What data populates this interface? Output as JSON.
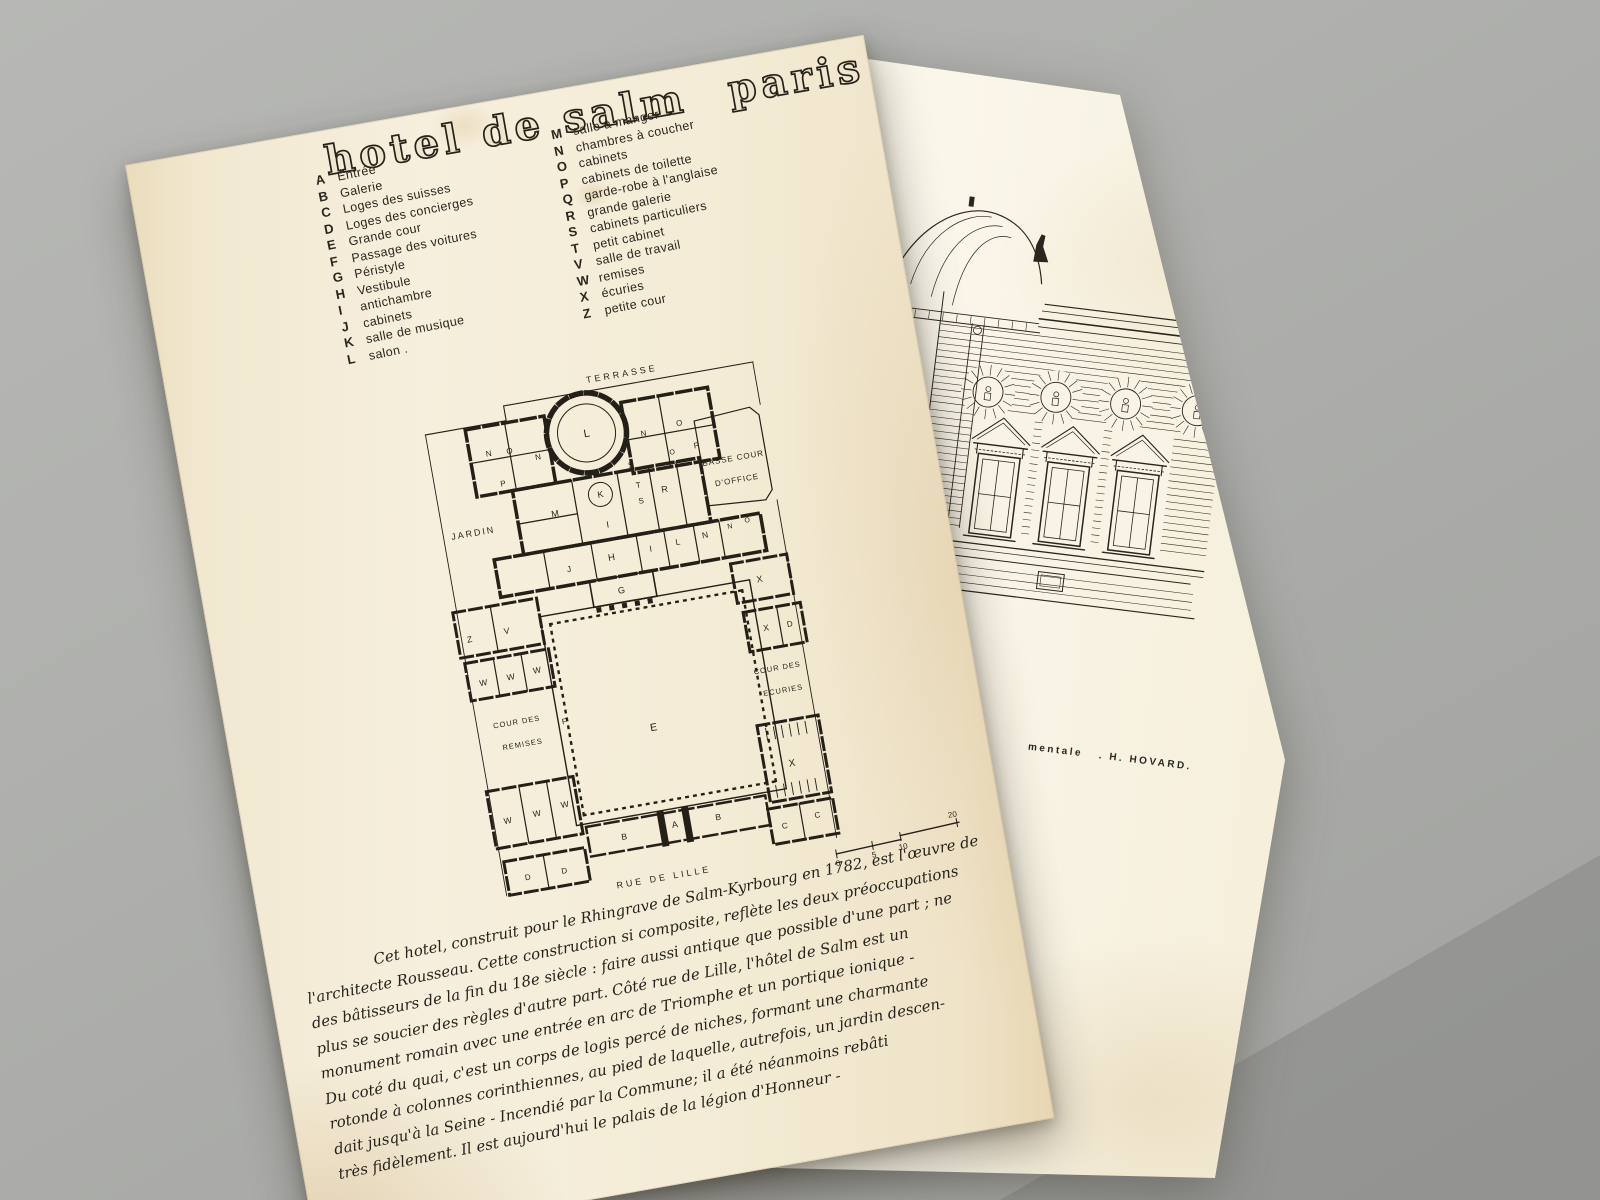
{
  "colors": {
    "background": "#aeafac",
    "paper_front": "#f4ecd7",
    "paper_back": "#f9f4e5",
    "ink": "#241f17"
  },
  "front_sheet": {
    "title_part1": "hotel de salm",
    "title_part2": "paris",
    "legend_left": [
      {
        "key": "A",
        "label": "Entrée"
      },
      {
        "key": "B",
        "label": "Galerie"
      },
      {
        "key": "C",
        "label": "Loges des suisses"
      },
      {
        "key": "D",
        "label": "Loges des concierges"
      },
      {
        "key": "E",
        "label": "Grande cour"
      },
      {
        "key": "F",
        "label": "Passage des voitures"
      },
      {
        "key": "G",
        "label": "Péristyle"
      },
      {
        "key": "H",
        "label": "Vestibule"
      },
      {
        "key": "I",
        "label": "antichambre"
      },
      {
        "key": "J",
        "label": "cabinets"
      },
      {
        "key": "K",
        "label": "salle de musique"
      },
      {
        "key": "L",
        "label": "salon ."
      }
    ],
    "legend_right": [
      {
        "key": "M",
        "label": "salle à manger"
      },
      {
        "key": "N",
        "label": "chambres à coucher"
      },
      {
        "key": "O",
        "label": "cabinets"
      },
      {
        "key": "P",
        "label": "cabinets de toilette"
      },
      {
        "key": "Q",
        "label": "garde-robe à l'anglaise"
      },
      {
        "key": "R",
        "label": "grande galerie"
      },
      {
        "key": "S",
        "label": "cabinets particuliers"
      },
      {
        "key": "T",
        "label": "petit cabinet"
      },
      {
        "key": "V",
        "label": "salle de travail"
      },
      {
        "key": "W",
        "label": "remises"
      },
      {
        "key": "X",
        "label": "écuries"
      },
      {
        "key": "Z",
        "label": "petite cour"
      }
    ],
    "plan": {
      "terrasse": "TERRASSE",
      "jardin": "JARDIN",
      "basse_cour_1": "BASSE COUR",
      "basse_cour_2": "D'OFFICE",
      "cour_remises_1": "COUR DES",
      "cour_remises_2": "REMISES",
      "cour_ecuries_1": "COUR DES",
      "cour_ecuries_2": "ECURIES",
      "rue": "RUE DE LILLE",
      "letters": [
        "L",
        "N",
        "O",
        "P",
        "N",
        "N",
        "O",
        "P",
        "O",
        "K",
        "M",
        "I",
        "S",
        "T",
        "S",
        "R",
        "J",
        "H",
        "I",
        "L",
        "N",
        "N",
        "O",
        "G",
        "E",
        "Z",
        "V",
        "F",
        "W",
        "W",
        "W",
        "X",
        "X",
        "D",
        "W",
        "W",
        "W",
        "X",
        "D",
        "D",
        "B",
        "A",
        "B",
        "C",
        "C"
      ],
      "scale_ticks": [
        "0",
        "5",
        "10",
        "20"
      ]
    },
    "paragraph": [
      "Cet hotel, construit pour le Rhingrave de Salm-Kyrbourg en 1782, est l'œuvre de",
      "l'architecte Rousseau. Cette construction si composite, reflète les deux préoccupations",
      "des bâtisseurs de la fin du 18e siècle : faire aussi antique que possible d'une part ; ne",
      "plus se soucier des règles d'autre part. Côté rue de Lille, l'hôtel de Salm est un",
      "monument romain avec une entrée en arc de Triomphe et un portique ionique -",
      "Du coté du quai, c'est un corps de logis percé de niches, formant une charmante",
      "rotonde à colonnes corinthiennes, au pied de laquelle, autrefois, un jardin descen-",
      "dait jusqu'à la Seine - Incendié par la Commune; il a été néanmoins rebâti",
      "très fidèlement. Il est aujourd'hui le palais de la légion d'Honneur -"
    ]
  },
  "back_sheet": {
    "caption_fragment": "mentale",
    "caption_author": ". H. HOVARD."
  }
}
